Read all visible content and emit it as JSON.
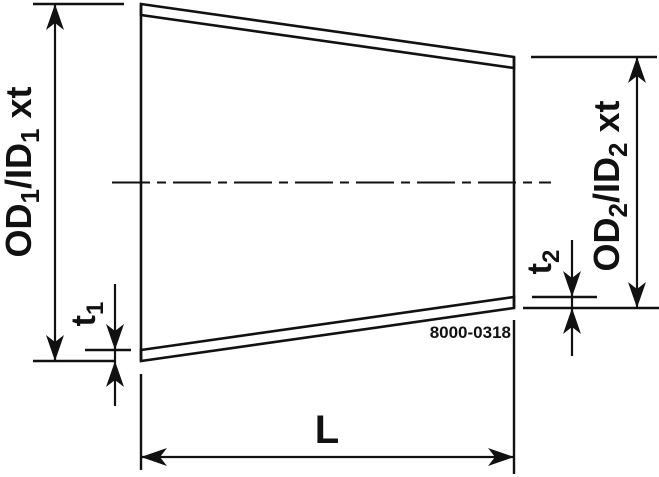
{
  "drawing": {
    "part_number": "8000-0318",
    "labels": {
      "od1": {
        "main1": "OD",
        "sub1": "1",
        "main2": "/ID",
        "sub2": "1",
        "suffix": "xt"
      },
      "od2": {
        "main1": "OD",
        "sub1": "2",
        "main2": "/ID",
        "sub2": "2",
        "suffix": "xt"
      },
      "t1": {
        "main": "t",
        "sub": "1"
      },
      "t2": {
        "main": "t",
        "sub": "2"
      },
      "length": "L"
    },
    "colors": {
      "line": "#111111",
      "background": "#ffffff"
    }
  }
}
